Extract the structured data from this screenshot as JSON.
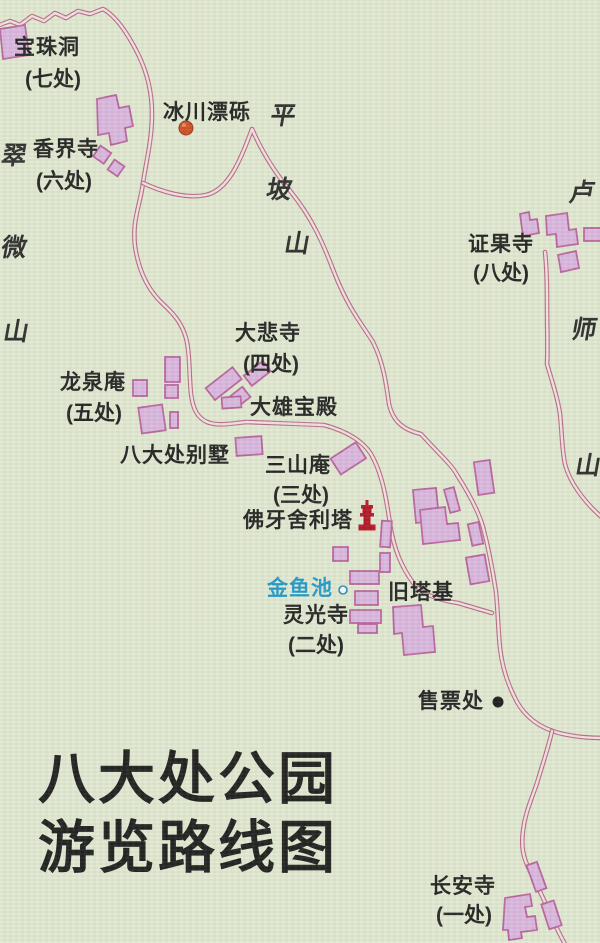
{
  "title": {
    "line1": "八大处公园",
    "line2": "游览路线图"
  },
  "places": {
    "baozhudong": {
      "name": "宝珠洞",
      "sub": "(七处)"
    },
    "bingchuan": {
      "name": "冰川漂砾"
    },
    "xiangjiesi": {
      "name": "香界寺",
      "sub": "(六处)"
    },
    "zhengguosi": {
      "name": "证果寺",
      "sub": "(八处)"
    },
    "dabeisi": {
      "name": "大悲寺",
      "sub": "(四处)"
    },
    "longquanan": {
      "name": "龙泉庵",
      "sub": "(五处)"
    },
    "daxiongbaodian": {
      "name": "大雄宝殿"
    },
    "badachubieshu": {
      "name": "八大处别墅"
    },
    "sanshanan": {
      "name": "三山庵",
      "sub": "(三处)"
    },
    "foyashelita": {
      "name": "佛牙舍利塔"
    },
    "jinyuchi": {
      "name": "金鱼池"
    },
    "jiutaji": {
      "name": "旧塔基"
    },
    "lingguangsi": {
      "name": "灵光寺",
      "sub": "(二处)"
    },
    "shoupiaochu": {
      "name": "售票处"
    },
    "changansi": {
      "name": "长安寺",
      "sub": "(一处)"
    }
  },
  "mountains": {
    "cuiwei": [
      "翠",
      "微",
      "山"
    ],
    "pingpo": [
      "平",
      "坡",
      "山"
    ],
    "lushi": [
      "卢",
      "师",
      "山"
    ]
  },
  "icons": {
    "boulder": "boulder-dot-icon",
    "pagoda": "pagoda-icon",
    "pond": "pond-circle-icon",
    "ticket_office": "ticket-office-dot-icon"
  },
  "colors": {
    "background": "#dfe7d0",
    "road_casing": "#b5677f",
    "road_fill": "#f1dee3",
    "building_fill": "#d9b4de",
    "building_stroke": "#b7609c",
    "ink": "#1c1c1c",
    "water_text": "#1b96c8",
    "boulder": "#cc4a1e",
    "pagoda": "#b00e20"
  }
}
